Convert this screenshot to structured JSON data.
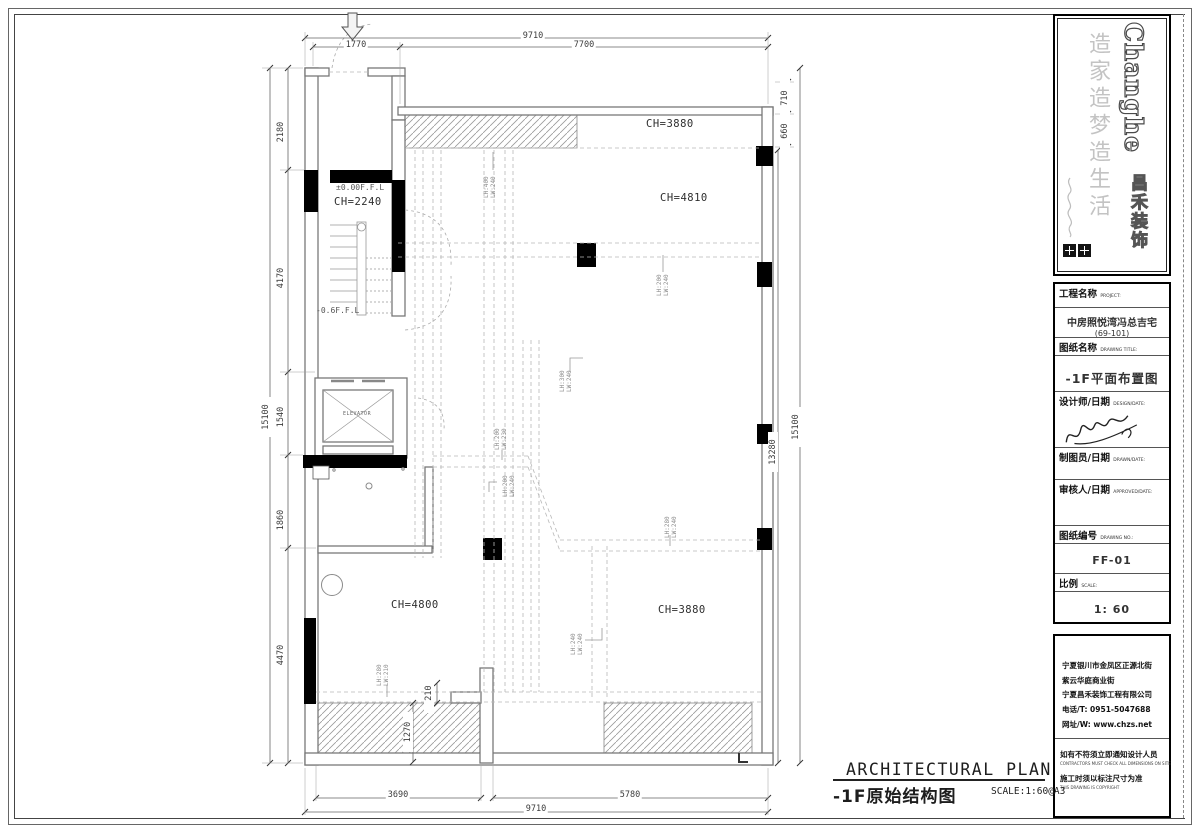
{
  "logo": {
    "brand": "Changhe",
    "brand_cn": "昌禾装饰",
    "slogan": "造家造梦造生活"
  },
  "title_block": {
    "project_label": "工程名称",
    "project_label_en": "PROJECT:",
    "project_name": "中房照悦湾冯总吉宅",
    "project_unit": "(69-101)",
    "drawing_title_label": "图纸名称",
    "drawing_title_label_en": "DRAWING TITLE:",
    "drawing_title": "-1F平面布置图",
    "designer_label": "设计师/日期",
    "designer_label_en": "DESIGN/DATE:",
    "drafter_label": "制图员/日期",
    "drafter_label_en": "DRAWN/DATE:",
    "approver_label": "审核人/日期",
    "approver_label_en": "APPROVED/DATE:",
    "drawing_no_label": "图纸编号",
    "drawing_no_label_en": "DRAWING NO.:",
    "drawing_no": "FF-01",
    "scale_label": "比例",
    "scale_label_en": "SCALE:",
    "scale": "1: 60"
  },
  "address_block": {
    "address1": "宁夏银川市金凤区正源北街",
    "address2": "紫云华庭商业街",
    "company": "宁夏昌禾装饰工程有限公司",
    "phone": "电话/T: 0951-5047688",
    "website": "网址/W: www.chzs.net",
    "note1": "如有不符须立即通知设计人员",
    "note1_en": "CONTRACTORS MUST CHECK ALL DIMENSIONS ON SITE",
    "note2": "施工时须以标注尺寸为准",
    "note2_en": "THIS DRAWING IS COPYRIGHT"
  },
  "footer": {
    "title_en": "ARCHITECTURAL PLAN",
    "title_cn": "-1F原始结构图",
    "scale_note": "SCALE:1:60@A3"
  },
  "plan": {
    "rooms": {
      "top": "CH=3880",
      "main": "CH=4810",
      "stair": "CH=2240",
      "left": "CH=4800",
      "right": "CH=3880"
    },
    "levels": {
      "entry": "±0.00F.F.L",
      "lower": "-0.6F.F.L"
    },
    "elevator": "ELEVATOR",
    "beams": [
      {
        "lh": "LH:400",
        "lw": "LW:240"
      },
      {
        "lh": "LH:200",
        "lw": "LW:240"
      },
      {
        "lh": "LH:300",
        "lw": "LW:240"
      },
      {
        "lh": "LH:200",
        "lw": "LW:230"
      },
      {
        "lh": "LH:200",
        "lw": "LW:240"
      },
      {
        "lh": "LH:280",
        "lw": "LW:240"
      },
      {
        "lh": "LH:240",
        "lw": "LW:240"
      },
      {
        "lh": "LH:280",
        "lw": "LW:210"
      }
    ],
    "dims": {
      "top": [
        "1770",
        "9710",
        "7700"
      ],
      "left": [
        "2180",
        "4170",
        "15100",
        "1540",
        "1860",
        "4470"
      ],
      "right": [
        "710",
        "660",
        "15100",
        "13280"
      ],
      "bottom": [
        "3690",
        "5780",
        "9710"
      ],
      "inner": [
        "1270",
        "210"
      ]
    }
  }
}
